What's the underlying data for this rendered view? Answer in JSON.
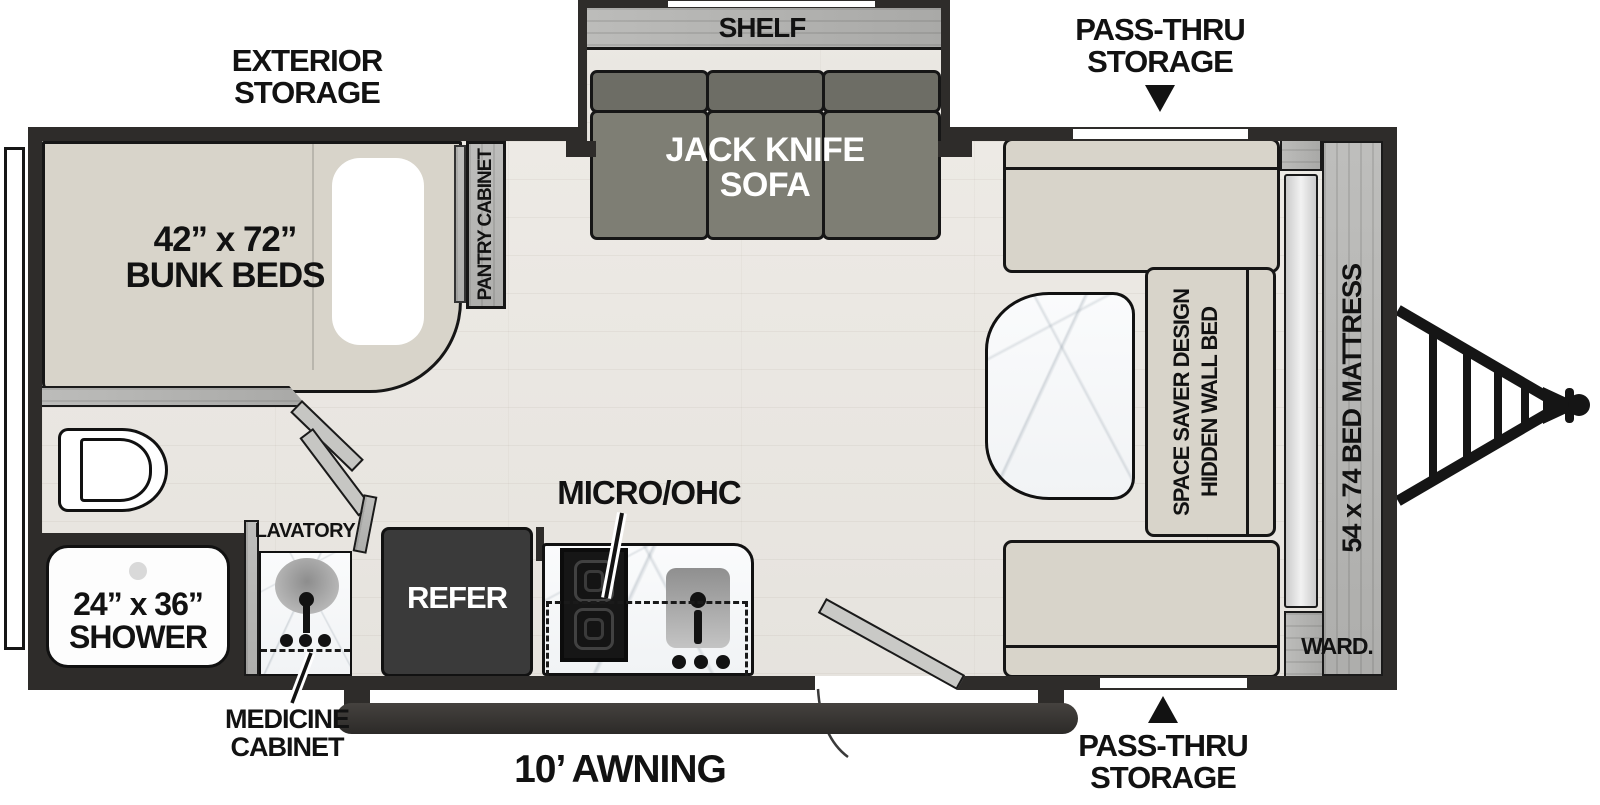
{
  "title": "Travel trailer floor plan",
  "colors": {
    "wall": "#2e2c2a",
    "floor_wood": "#eae7e2",
    "furniture_beige": "#d8d4ca",
    "sofa_back": "#6d6d65",
    "sofa_seat": "#7e7e74",
    "cabinet_wood_gray": "#b6b6b4",
    "refrigerator": "#3a3a3a",
    "counter_marble": "#f8f9fa",
    "cooktop_black": "#161616",
    "label_text": "#121212"
  },
  "labels": {
    "exterior_storage_1": "EXTERIOR",
    "exterior_storage_2": "STORAGE",
    "pass_thru_1": "PASS-THRU",
    "pass_thru_2": "STORAGE",
    "shelf": "SHELF",
    "sofa_1": "JACK KNIFE",
    "sofa_2": "SOFA",
    "bunk_1": "42” x 72”",
    "bunk_2": "BUNK BEDS",
    "pantry": "PANTRY CABINET",
    "mattress": "54 x 74 BED MATTRESS",
    "wall_bed_1": "SPACE SAVER DESIGN",
    "wall_bed_2": "HIDDEN WALL BED",
    "ward": "WARD.",
    "shower_1": "24” x 36”",
    "shower_2": "SHOWER",
    "lavatory": "LAVATORY",
    "medicine_1": "MEDICINE",
    "medicine_2": "CABINET",
    "refer": "REFER",
    "micro": "MICRO/OHC",
    "awning": "10’ AWNING"
  }
}
